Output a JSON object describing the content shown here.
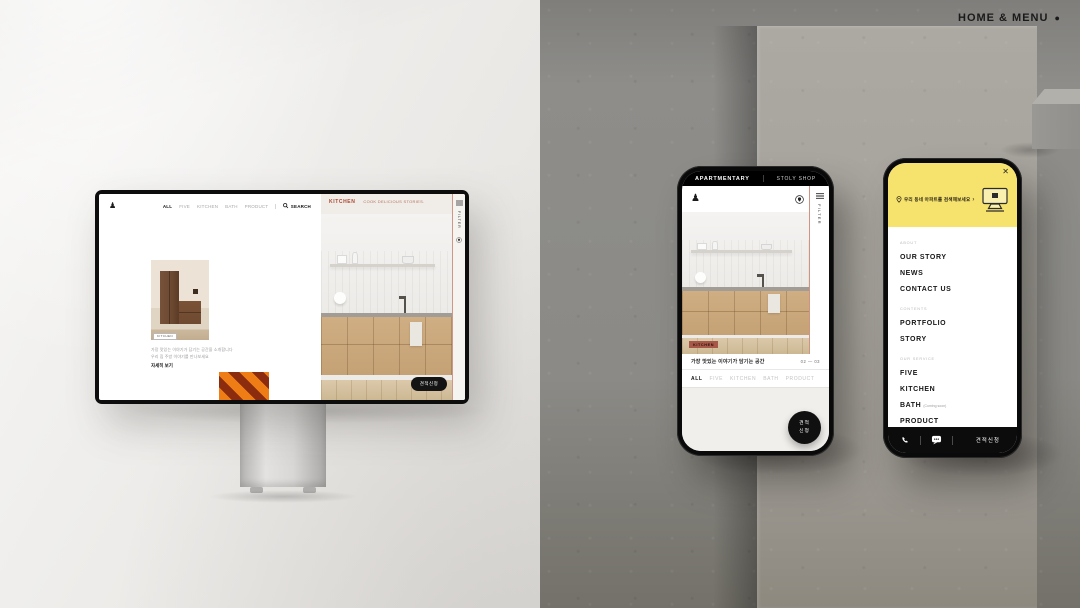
{
  "scene": {
    "home_menu": "HOME & MENU",
    "dot": "●"
  },
  "icons": {
    "logo": "♟",
    "close": "✕"
  },
  "monitor": {
    "nav": {
      "items": [
        "ALL",
        "FIVE",
        "KITCHEN",
        "BATH",
        "PRODUCT"
      ],
      "search": "SEARCH"
    },
    "story": {
      "tag": "KITCHEN",
      "line1": "가장 맛있는 이야기가 담기는 공간을 소개합니다",
      "line2": "우리 집 주방 이야기를 만나보세요",
      "link": "자세히 보기"
    },
    "kitchen_header": {
      "title": "KITCHEN",
      "subtitle": "COOK DELICIOUS STORIES."
    },
    "rail_text": "FILTER",
    "cta": "견적신청"
  },
  "phone1": {
    "topbar": {
      "left": "APARTMENTARY",
      "right": "STOLY SHOP"
    },
    "rail_text": "FILTER",
    "badge": "KITCHEN",
    "title": "가장 맛있는 이야기가 담기는 공간",
    "pager": "02 — 03",
    "filters": [
      "ALL",
      "FIVE",
      "KITCHEN",
      "BATH",
      "PRODUCT"
    ],
    "fab": {
      "line1": "견적",
      "line2": "신청"
    }
  },
  "phone2": {
    "banner": {
      "text": "우리 동네 아파트를 검색해보세요",
      "arrow": "›"
    },
    "sections": [
      {
        "label": "ABOUT",
        "items": [
          {
            "text": "OUR STORY"
          },
          {
            "text": "NEWS"
          },
          {
            "text": "CONTACT US"
          }
        ]
      },
      {
        "label": "CONTENTS",
        "items": [
          {
            "text": "PORTFOLIO"
          },
          {
            "text": "STORY"
          }
        ]
      },
      {
        "label": "OUR SERVICE",
        "items": [
          {
            "text": "FIVE"
          },
          {
            "text": "KITCHEN"
          },
          {
            "text": "BATH",
            "suffix": "(Coming soon)"
          },
          {
            "text": "PRODUCT"
          }
        ]
      }
    ],
    "bottom_cta": "견적신청"
  }
}
